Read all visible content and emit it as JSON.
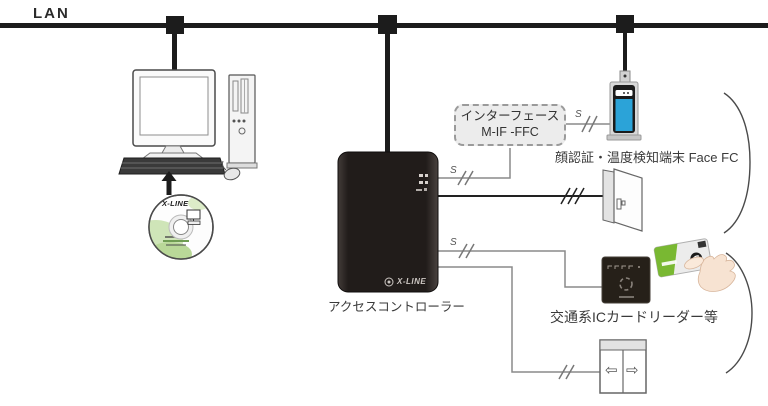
{
  "lan": {
    "label": "LAN"
  },
  "wires": {
    "serial_label": "S"
  },
  "controller": {
    "label": "アクセスコントローラー",
    "brand": "X-LINE"
  },
  "interface_box": {
    "line1": "インターフェース",
    "line2": "M-IF -FFC"
  },
  "face_terminal": {
    "label": "顔認証・温度検知端末 Face FC"
  },
  "card_reader": {
    "label": "交通系ICカードリーダー等"
  },
  "cd": {
    "brand": "X-LINE"
  },
  "elevator": {
    "left_arrow": "⇦",
    "right_arrow": "⇨"
  },
  "colors": {
    "bus_black": "#1c1c1c",
    "wire_gray": "#8a8a8a",
    "controller_body": "#241f1d",
    "screen_blue": "#2ba3d8",
    "card_green": "#79b832"
  }
}
